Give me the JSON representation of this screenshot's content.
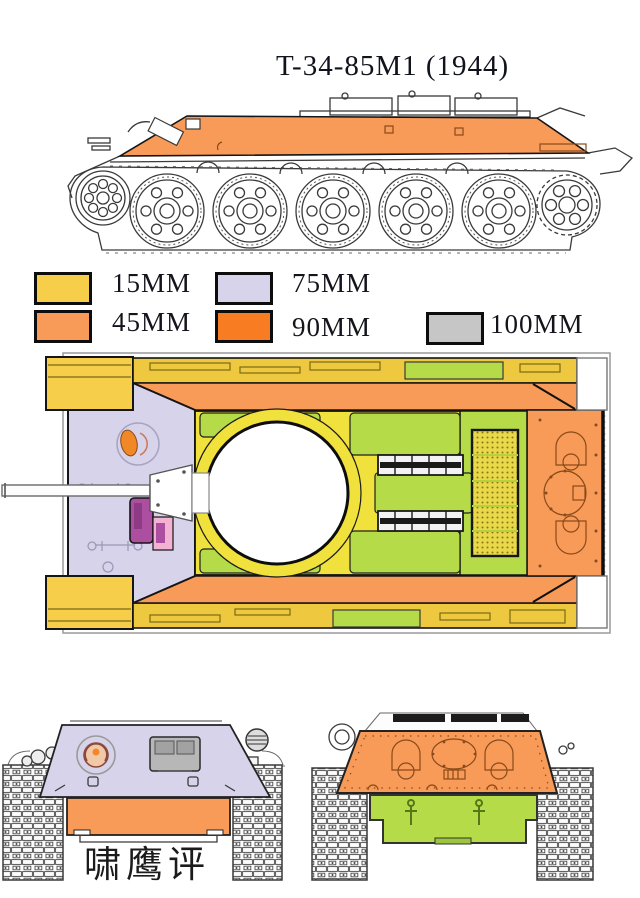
{
  "title": "T-34-85M1 (1944)",
  "watermark": "啸鹰评",
  "legend": {
    "items": [
      {
        "label": "15MM",
        "color": "#F6CE4A"
      },
      {
        "label": "45MM",
        "color": "#F89B58"
      },
      {
        "label": "75MM",
        "color": "#D7D3EA"
      },
      {
        "label": "90MM",
        "color": "#F87D22"
      },
      {
        "label": "100MM",
        "color": "#C6C6C6"
      }
    ]
  },
  "colors": {
    "armor15": "#F6CE4A",
    "armor45": "#F89B58",
    "armor75": "#D7D3EA",
    "armor90": "#F87D22",
    "armor100": "#C6C6C6",
    "deck_green": "#B5DC48",
    "deck_yellow": "#F1E13C",
    "fender_yellow": "#EEC83E",
    "grille_yellow": "#E9D94A",
    "hatch_magenta": "#AC4FA0",
    "hatch_pink": "#F4B2D3",
    "mg_orange": "#F08828",
    "outline": "#3a3a3a"
  }
}
